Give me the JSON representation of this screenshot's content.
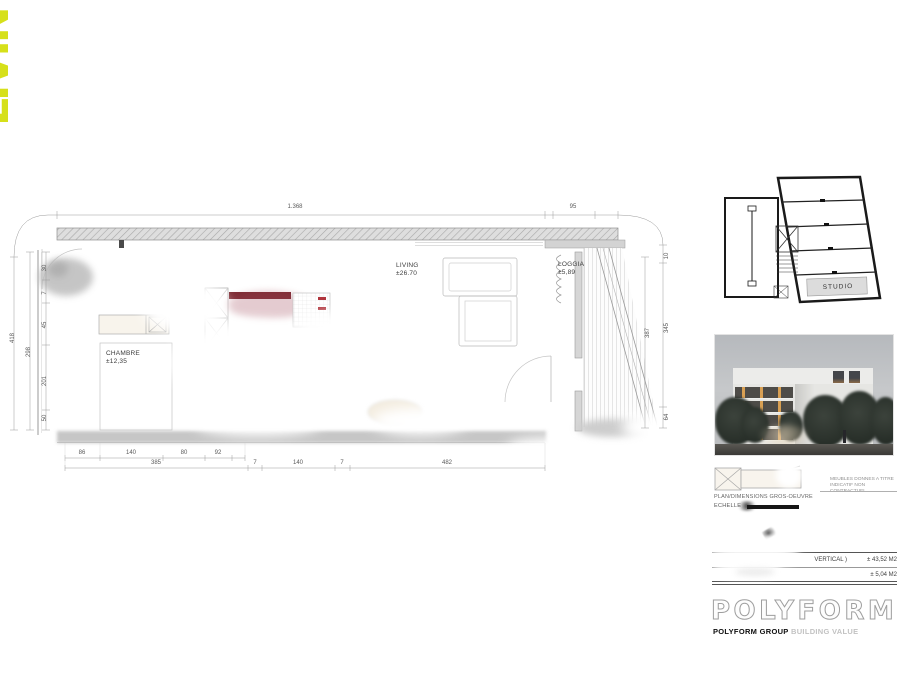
{
  "logo": {
    "text": "LIVIN",
    "color": "#d6e01a"
  },
  "plan": {
    "rooms": {
      "chambre": {
        "name": "CHAMBRE",
        "area": "±12,35"
      },
      "living": {
        "name": "LIVING",
        "area": "±26.70"
      },
      "loggia": {
        "name": "LOGGIA",
        "area": "±5,89"
      }
    },
    "dims": {
      "top_total": "1.368",
      "top_loggia": "95",
      "left_total": "418",
      "left_inner": "298",
      "left_chain": [
        "30",
        "7",
        "45",
        "201",
        "50"
      ],
      "right_loggia_height": "387",
      "right_chain": [
        "10",
        "345",
        "64"
      ],
      "bottom_row1": [
        "86",
        "140",
        "80",
        "92"
      ],
      "bottom_row2": [
        "385",
        "7",
        "140",
        "7"
      ],
      "bottom_living": "482"
    }
  },
  "keyplan": {
    "unit_label": "STUDIO"
  },
  "legend": {
    "caption": "PLAN/DIMENSIONS GROS-OEUVRE",
    "scale_label": "ECHELLE",
    "note_line1": "MEUBLES DONNES A TITRE",
    "note_line2": "INDICATIF NON CONTRACTUEL"
  },
  "surface_table": {
    "rows": [
      {
        "label": "VERTICAL )",
        "value": "± 43,52 M2"
      },
      {
        "label": "",
        "value": "± 5,04 M2"
      }
    ]
  },
  "brand": {
    "wordmark": "POLYFORM",
    "group": "POLYFORM GROUP",
    "tagline": "BUILDING VALUE"
  },
  "colors": {
    "accent": "#d6e01a",
    "kitchen_red": "#7d2b33",
    "studio_fill": "#dcdcdc"
  }
}
